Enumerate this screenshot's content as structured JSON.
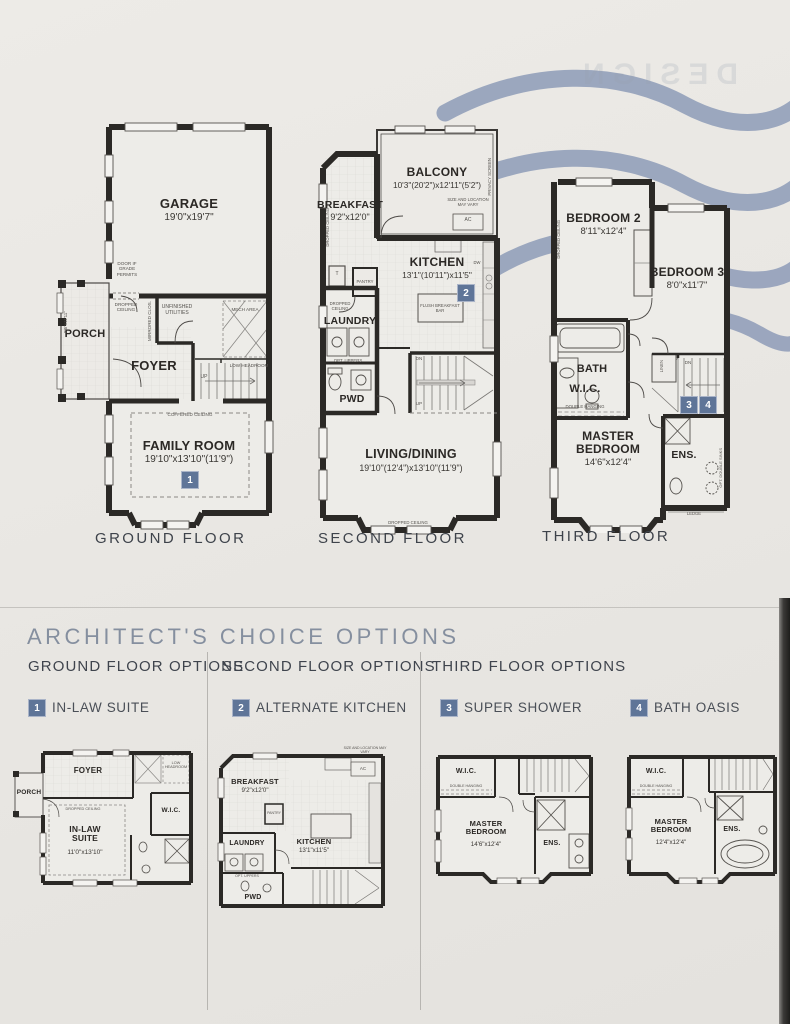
{
  "page": {
    "bg": "#e9e7e3",
    "wave_color": "#94a1bb",
    "wall_color": "#2b2926",
    "badge_bg": "#5f7598",
    "title_color": "#858f9f",
    "header_color": "#3f444d",
    "floor_label_color": "#3e434b"
  },
  "decor": {
    "bleed": "DESIGN"
  },
  "floors": {
    "ground": {
      "label": "GROUND FLOOR",
      "garage": {
        "name": "GARAGE",
        "dims": "19'0\"x19'7\""
      },
      "porch": {
        "name": "PORCH",
        "dims": "8'6\"x11'11\""
      },
      "foyer": {
        "name": "FOYER"
      },
      "family": {
        "name": "FAMILY ROOM",
        "dims": "19'10\"x13'10\"(11'9\")",
        "badge": "1"
      },
      "notes": {
        "door_grade": "DOOR IF GRADE PERMITS",
        "dropped_ceiling": "DROPPED CEILING",
        "mirrored": "MIRRORED CLOS.",
        "unfinished": "UNFINISHED UTILITIES",
        "mech": "MECH AREA",
        "low_headroom": "LOW HEADROOM",
        "up": "UP",
        "coffered": "COFFERED CEILING"
      }
    },
    "second": {
      "label": "SECOND FLOOR",
      "balcony": {
        "name": "BALCONY",
        "dims": "10'3\"(20'2\")x12'11\"(5'2\")"
      },
      "breakfast": {
        "name": "BREAKFAST",
        "dims": "9'2\"x12'0\""
      },
      "kitchen": {
        "name": "KITCHEN",
        "dims": "13'1\"(10'11\")x11'5\"",
        "badge": "2"
      },
      "laundry": {
        "name": "LAUNDRY"
      },
      "pwd": {
        "name": "PWD"
      },
      "living": {
        "name": "LIVING/DINING",
        "dims": "19'10\"(12'4\")x13'10\"(11'9\")"
      },
      "notes": {
        "privacy": "PRIVACY SCREEN",
        "ac_note": "SIZE AND LOCATION MAY VARY",
        "ac": "AC",
        "t": "T",
        "pantry": "PANTRY",
        "dropped_ceiling": "DROPPED CEILING",
        "opt_uppers": "OPT. UPPERS",
        "flush_bar": "FLUSH BREAKFAST BAR",
        "dw": "DW",
        "dn": "DN",
        "up": "UP",
        "dropped_bottom": "DROPPED CEILING"
      }
    },
    "third": {
      "label": "THIRD FLOOR",
      "bedroom2": {
        "name": "BEDROOM 2",
        "dims": "8'11\"x12'4\""
      },
      "bedroom3": {
        "name": "BEDROOM 3",
        "dims": "8'0\"x11'7\""
      },
      "bath": {
        "name": "BATH"
      },
      "wic": {
        "name": "W.I.C."
      },
      "master": {
        "name": "MASTER BEDROOM",
        "dims": "14'6\"x12'4\""
      },
      "ens": {
        "name": "ENS."
      },
      "badge3": "3",
      "badge4": "4",
      "notes": {
        "dropped_ceiling": "DROPPED CEILING",
        "linen": "LINEN",
        "dn": "DN",
        "double_hanging": "DOUBLE HANGING",
        "opt_sinks": "OPT. DOUBLE SINKS",
        "ledge": "LEDGE"
      }
    }
  },
  "options": {
    "title": "ARCHITECT'S CHOICE OPTIONS",
    "columns": [
      {
        "header": "GROUND FLOOR OPTIONS"
      },
      {
        "header": "SECOND FLOOR OPTIONS"
      },
      {
        "header": "THIRD FLOOR OPTIONS"
      }
    ],
    "items": [
      {
        "badge": "1",
        "label": "IN-LAW SUITE"
      },
      {
        "badge": "2",
        "label": "ALTERNATE KITCHEN"
      },
      {
        "badge": "3",
        "label": "SUPER SHOWER"
      },
      {
        "badge": "4",
        "label": "BATH OASIS"
      }
    ]
  },
  "option_plans": {
    "inlaw": {
      "porch": "PORCH",
      "foyer": "FOYER",
      "low_headroom": "LOW HEADROOM",
      "dropped": "DROPPED CEILING",
      "suite_name": "IN-LAW SUITE",
      "suite_dims": "11'0\"x13'10\"",
      "wic": "W.I.C."
    },
    "altkitchen": {
      "breakfast": "BREAKFAST",
      "breakfast_dims": "9'2\"x12'0\"",
      "ac_note": "SIZE AND LOCATION MAY VARY",
      "ac": "AC",
      "pantry": "PANTRY",
      "kitchen": "KITCHEN",
      "kitchen_dims": "13'1\"x11'5\"",
      "laundry": "LAUNDRY",
      "opt_uppers": "OPT. UPPERS",
      "pwd": "PWD"
    },
    "supershower": {
      "wic": "W.I.C.",
      "double_hanging": "DOUBLE HANGING",
      "master": "MASTER BEDROOM",
      "master_dims": "14'6\"x12'4\"",
      "ens": "ENS."
    },
    "bathoasis": {
      "wic": "W.I.C.",
      "double_hanging": "DOUBLE HANGING",
      "master": "MASTER BEDROOM",
      "master_dims": "12'4\"x12'4\"",
      "ens": "ENS."
    }
  }
}
